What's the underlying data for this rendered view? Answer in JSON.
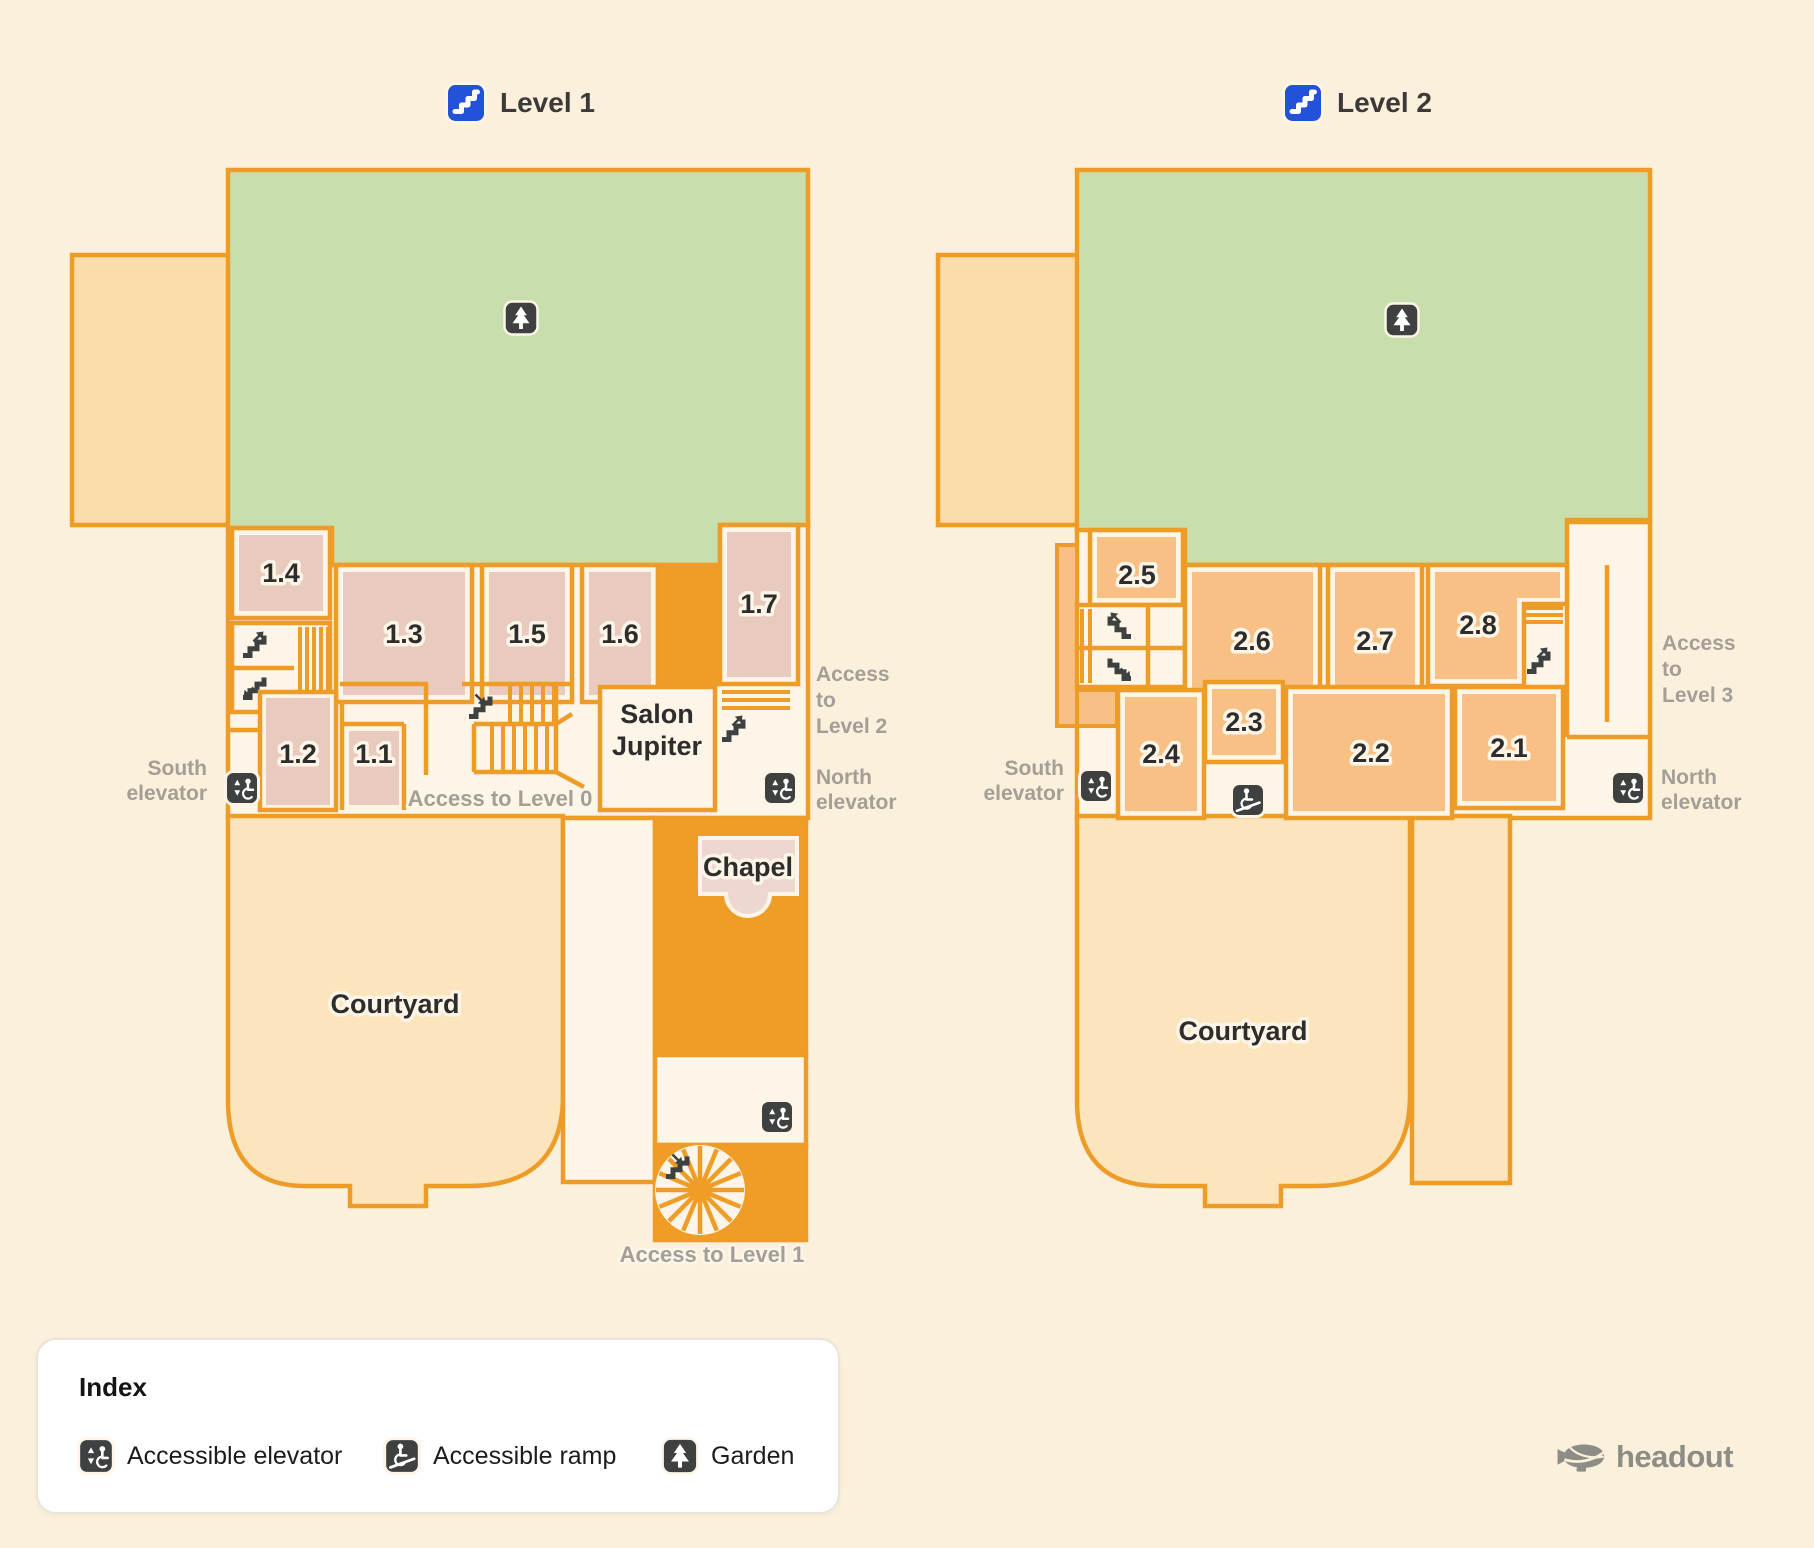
{
  "titles": {
    "level1": "Level 1",
    "level2": "Level 2"
  },
  "level1": {
    "rooms": {
      "r1": "1.1",
      "r2": "1.2",
      "r3": "1.3",
      "r4": "1.4",
      "r5": "1.5",
      "r6": "1.6",
      "r7": "1.7"
    },
    "places": {
      "salon": [
        "Salon",
        "Jupiter"
      ],
      "chapel": "Chapel",
      "courtyard": "Courtyard"
    },
    "annotations": {
      "south_elevator": [
        "South",
        "elevator"
      ],
      "north_elevator": [
        "North",
        "elevator"
      ],
      "access_level2": [
        "Access",
        "to",
        "Level 2"
      ],
      "access_level0": "Access to Level 0",
      "access_level1": "Access to Level 1"
    }
  },
  "level2": {
    "rooms": {
      "r1": "2.1",
      "r2": "2.2",
      "r3": "2.3",
      "r4": "2.4",
      "r5": "2.5",
      "r6": "2.6",
      "r7": "2.7",
      "r8": "2.8"
    },
    "places": {
      "courtyard": "Courtyard"
    },
    "annotations": {
      "south_elevator": [
        "South",
        "elevator"
      ],
      "north_elevator": [
        "North",
        "elevator"
      ],
      "access_level3": [
        "Access",
        "to",
        "Level 3"
      ]
    }
  },
  "index": {
    "title": "Index",
    "items": [
      {
        "icon": "accessible-elevator-icon",
        "label": "Accessible elevator"
      },
      {
        "icon": "accessible-ramp-icon",
        "label": "Accessible ramp"
      },
      {
        "icon": "garden-icon",
        "label": "Garden"
      }
    ]
  },
  "logo": {
    "text": "headout"
  },
  "colors": {
    "background": "#fbf0dc",
    "wall_orange": "#ee9c28",
    "corridor_orange": "#f09d28",
    "garden_green": "#c8dfad",
    "room_pink": "#e9cabf",
    "room_orange": "#f9c085",
    "courtyard": "#fce4bc",
    "annex": "#fbdcab",
    "floor": "#fdf5e7",
    "badge_blue": "#2152d8",
    "icon_dark": "#3f4040",
    "label_gray": "#a49f96"
  }
}
